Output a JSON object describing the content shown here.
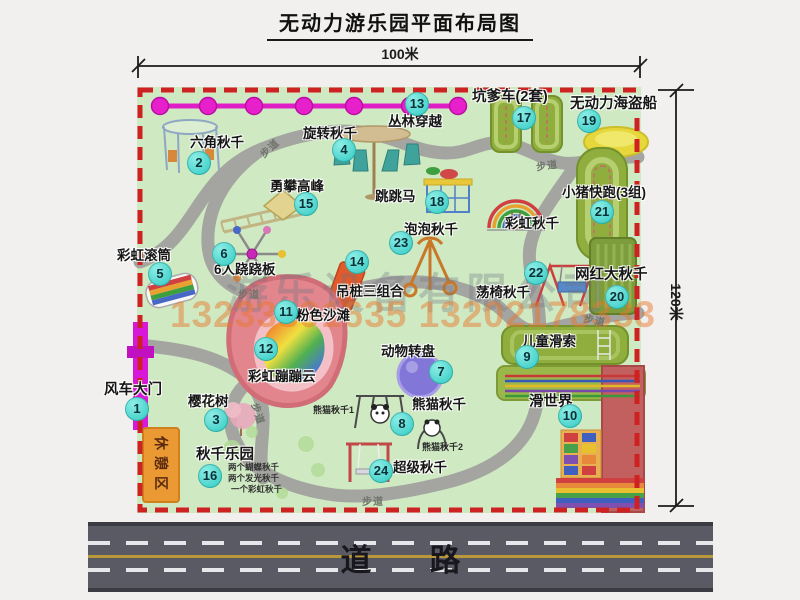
{
  "title": "无动力游乐园平面布局图",
  "dimensions": {
    "width": "100米",
    "height": "120米"
  },
  "road": {
    "label": "道路"
  },
  "walkway_label": "步道",
  "watermark": {
    "company": "游乐设备有限公司",
    "phones": "13233891635 13202178333"
  },
  "rest_area": {
    "label": "休憩区"
  },
  "rainbow_swing_label": "彩虹秋千",
  "attractions": [
    {
      "id": 1,
      "name": "风车大门"
    },
    {
      "id": 2,
      "name": "六角秋千"
    },
    {
      "id": 3,
      "name": "樱花树"
    },
    {
      "id": 4,
      "name": "旋转秋千"
    },
    {
      "id": 5,
      "name": "彩虹滚筒"
    },
    {
      "id": 6,
      "name": "6人跷跷板"
    },
    {
      "id": 7,
      "name": "动物转盘"
    },
    {
      "id": 8,
      "name": "熊猫秋千"
    },
    {
      "id": 9,
      "name": "儿童滑索"
    },
    {
      "id": 10,
      "name": "滑世界"
    },
    {
      "id": 11,
      "name": "粉色沙滩"
    },
    {
      "id": 12,
      "name": "彩虹蹦蹦云"
    },
    {
      "id": 13,
      "name": "丛林穿越"
    },
    {
      "id": 14,
      "name": "吊桩三组合"
    },
    {
      "id": 15,
      "name": "勇攀高峰"
    },
    {
      "id": 16,
      "name": "秋千乐园"
    },
    {
      "id": 17,
      "name": "坑爹车(2套)"
    },
    {
      "id": 18,
      "name": "跳跳马"
    },
    {
      "id": 19,
      "name": "无动力海盗船"
    },
    {
      "id": 20,
      "name": "网红大秋千"
    },
    {
      "id": 21,
      "name": "小猪快跑(3组)"
    },
    {
      "id": 22,
      "name": "荡椅秋千"
    },
    {
      "id": 23,
      "name": "泡泡秋千"
    },
    {
      "id": 24,
      "name": "超级秋千"
    }
  ],
  "sub_labels": {
    "panda_swing_1": "熊猫秋千1",
    "panda_swing_2": "熊猫秋千2",
    "swing_park_note_1": "两个蝴蝶秋千",
    "swing_park_note_2": "两个发光秋千",
    "swing_park_note_3": "一个彩虹秋千"
  },
  "colors": {
    "marker_cyan": "#3ed2cb",
    "border_dash_red": "#ce2222",
    "map_green": "#cfe9c2",
    "path_gray": "#a4a5a0",
    "chain_magenta": "#e01ec8",
    "road_asphalt": "#5a5a64",
    "rest_area_orange": "#eb9a33"
  }
}
